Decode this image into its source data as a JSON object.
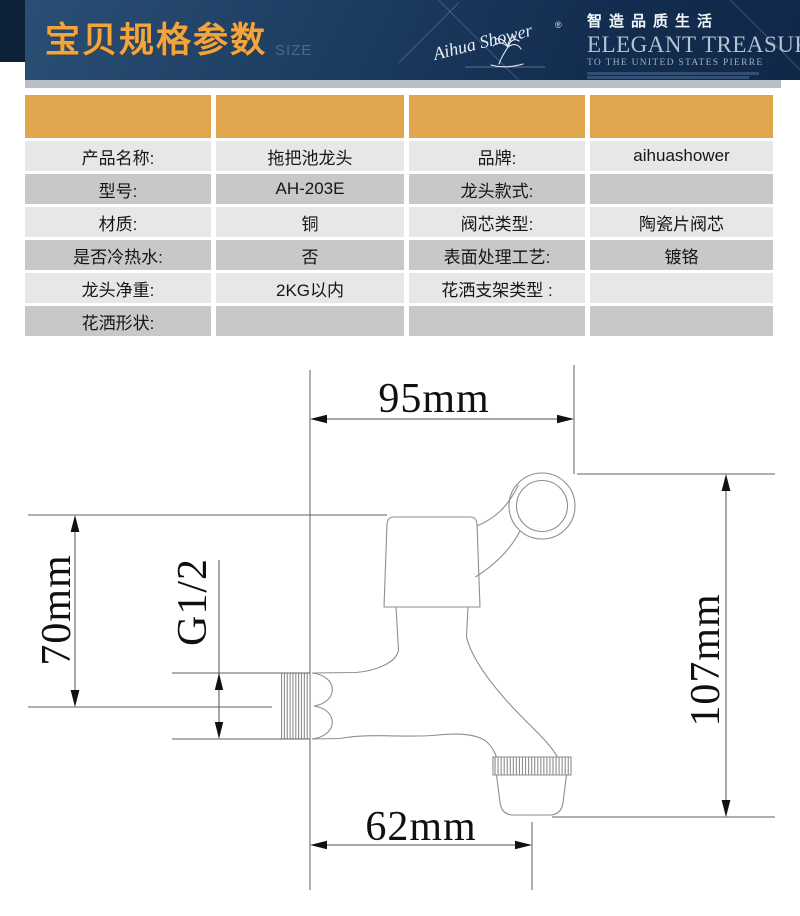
{
  "header": {
    "title": "宝贝规格参数",
    "subtitle": "SIZE",
    "brand_script": "Aihua Shower",
    "reg_mark": "®",
    "slogan_cn": "智造品质生活",
    "slogan_en": "ELEGANT TREASURES",
    "slogan_sub": "TO THE UNITED STATES PIERRE"
  },
  "table": {
    "header_cols": 4,
    "rows": [
      {
        "cells": [
          "产品名称:",
          "拖把池龙头",
          "品牌:",
          "aihuashower"
        ]
      },
      {
        "cells": [
          "型号:",
          "AH-203E",
          "龙头款式:",
          ""
        ]
      },
      {
        "cells": [
          "材质:",
          "铜",
          "阀芯类型:",
          "陶瓷片阀芯"
        ]
      },
      {
        "cells": [
          "是否冷热水:",
          "否",
          "表面处理工艺:",
          "镀铬"
        ]
      },
      {
        "cells": [
          "龙头净重:",
          "2KG以内",
          "花洒支架类型 :",
          ""
        ]
      },
      {
        "cells": [
          "花洒形状:",
          "",
          "",
          ""
        ]
      }
    ]
  },
  "diagram": {
    "width_top": "95mm",
    "height_left": "70mm",
    "thread": "G1/2",
    "height_right": "107mm",
    "width_bottom": "62mm"
  },
  "colors": {
    "banner_navy": "#16355b",
    "banner_strip": "#0d2138",
    "title_gold": "#f2a53e",
    "table_header_gold": "#e0a64d",
    "row_light": "#e7e7e7",
    "row_dark": "#c8c8c8",
    "divider_gray": "#b7c0c8",
    "drawing_line_gray": "#8e8e8e"
  }
}
